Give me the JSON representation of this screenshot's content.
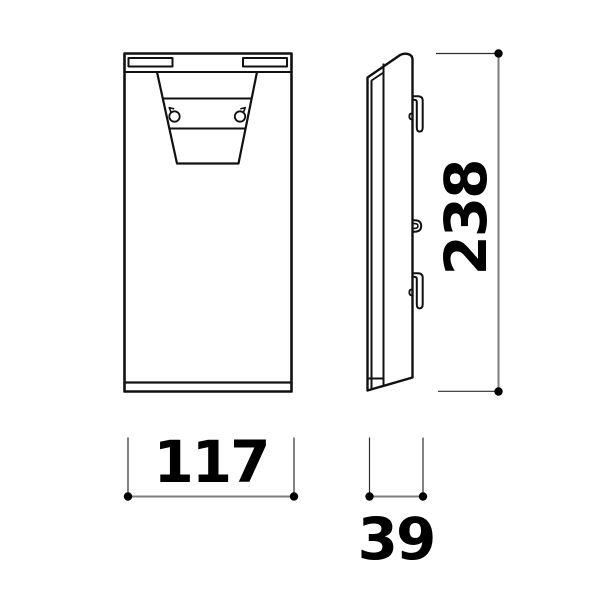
{
  "drawing": {
    "views": {
      "front": {
        "label": "front-view"
      },
      "side": {
        "label": "side-view"
      }
    },
    "dimensions": {
      "height": {
        "value": "238"
      },
      "width": {
        "value": "117"
      },
      "depth": {
        "value": "39"
      }
    },
    "colors": {
      "outline": "#111111",
      "dimension_line": "#7d7d7d",
      "extension_line": "#2e2e2e",
      "marker_dot": "#000000",
      "text": "#000000",
      "background": "#ffffff"
    }
  }
}
